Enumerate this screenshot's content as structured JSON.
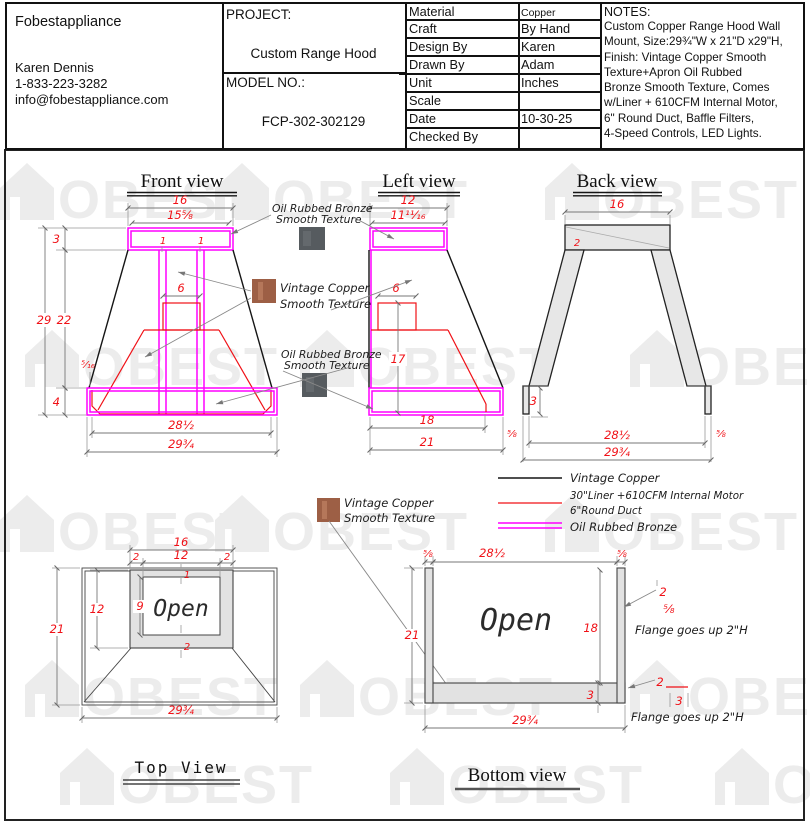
{
  "header": {
    "company": {
      "name": "Fobestappliance",
      "contact_name": "Karen Dennis",
      "phone": "1-833-223-3282",
      "email": "info@fobestappliance.com"
    },
    "project": {
      "label": "PROJECT:",
      "value": "Custom Range Hood"
    },
    "model": {
      "label": "MODEL NO.:",
      "value": "FCP-302-302129"
    },
    "specs": [
      {
        "label": "Material",
        "value": "Copper"
      },
      {
        "label": "Craft",
        "value": "By Hand"
      },
      {
        "label": "Design By",
        "value": "Karen"
      },
      {
        "label": "Drawn By",
        "value": "Adam"
      },
      {
        "label": "Unit",
        "value": "Inches"
      },
      {
        "label": "Scale",
        "value": ""
      },
      {
        "label": "Date",
        "value": "10-30-25"
      },
      {
        "label": "Checked By",
        "value": ""
      }
    ],
    "notes": {
      "title": "NOTES:",
      "lines": [
        "Custom Copper Range Hood Wall",
        "Mount, Size:29¾\"W x 21\"D x29\"H,",
        "Finish: Vintage Copper Smooth",
        "Texture+Apron Oil Rubbed",
        "Bronze Smooth Texture, Comes",
        "w/Liner + 610CFM Internal Motor,",
        "6\" Round Duct, Baffle Filters,",
        "4-Speed Controls, LED Lights."
      ]
    }
  },
  "front_view": {
    "title": "Front view",
    "dims": {
      "w_top": "16",
      "w_band": "15⅝",
      "band_h": "3",
      "gap_left": "1",
      "gap_right": "1",
      "duct_w": "6",
      "total_h": "29",
      "body_h": "22",
      "apron_inset": "⁵⁄₁₆",
      "apron_h": "4",
      "w_lower": "28½",
      "w_total": "29¾"
    }
  },
  "left_view": {
    "title": "Left view",
    "dims": {
      "d_top": "12",
      "d_band": "11¹¹⁄₁₆",
      "duct_w": "6",
      "liner_h": "17",
      "d_lower": "18",
      "d_total": "21"
    }
  },
  "back_view": {
    "title": "Back view",
    "dims": {
      "w_top": "16",
      "band_h": "2",
      "foot_h": "3",
      "foot_w_left": "⅝",
      "w_lower": "28½",
      "w_total": "29¾",
      "foot_w_right": "⅝"
    }
  },
  "top_view": {
    "title": "Top View",
    "open_label": "Open",
    "dims": {
      "collar_w": "16",
      "rim_left": "2",
      "hole_w": "12",
      "rim_right": "2",
      "rim_top": "1",
      "collar_d": "12",
      "hole_d": "9",
      "total_d": "21",
      "rim_bottom": "2",
      "total_w": "29¾"
    }
  },
  "bottom_view": {
    "title": "Bottom view",
    "open_label": "Open",
    "dims": {
      "wall_left": "⅝",
      "inner_w": "28½",
      "wall_right": "⅝",
      "total_d": "21",
      "inner_d": "18",
      "bottom_t": "3",
      "total_w": "29¾"
    },
    "flange_right": {
      "h": "2",
      "w": "⅝",
      "note": "Flange goes up 2\"H"
    },
    "flange_bottom": {
      "h": "2",
      "d": "3",
      "note": "Flange goes up 2\"H"
    }
  },
  "annotations": {
    "orb_top": {
      "line1": "Oil Rubbed Bronze",
      "line2": "Smooth Texture"
    },
    "vintage_mid": {
      "line1": "Vintage Copper",
      "line2": "Smooth Texture"
    },
    "orb_lower": {
      "line1": "Oil Rubbed Bronze",
      "line2": "Smooth Texture"
    },
    "vintage_page": {
      "line1": "Vintage Copper",
      "line2": "Smooth Texture"
    }
  },
  "legend": {
    "copper_label": "Vintage Copper",
    "liner_label_1": "30\"Liner +610CFM  Internal Motor",
    "liner_label_2": "6\"Round Duct",
    "bronze_label": "Oil Rubbed Bronze"
  },
  "watermark": {
    "text": "OBEST"
  },
  "colors": {
    "magenta": "#ff00ff",
    "red": "#f01016",
    "copper_swatch": "#9d5f45",
    "bronze_swatch": "#565b5f",
    "watermark": "#ececec"
  }
}
